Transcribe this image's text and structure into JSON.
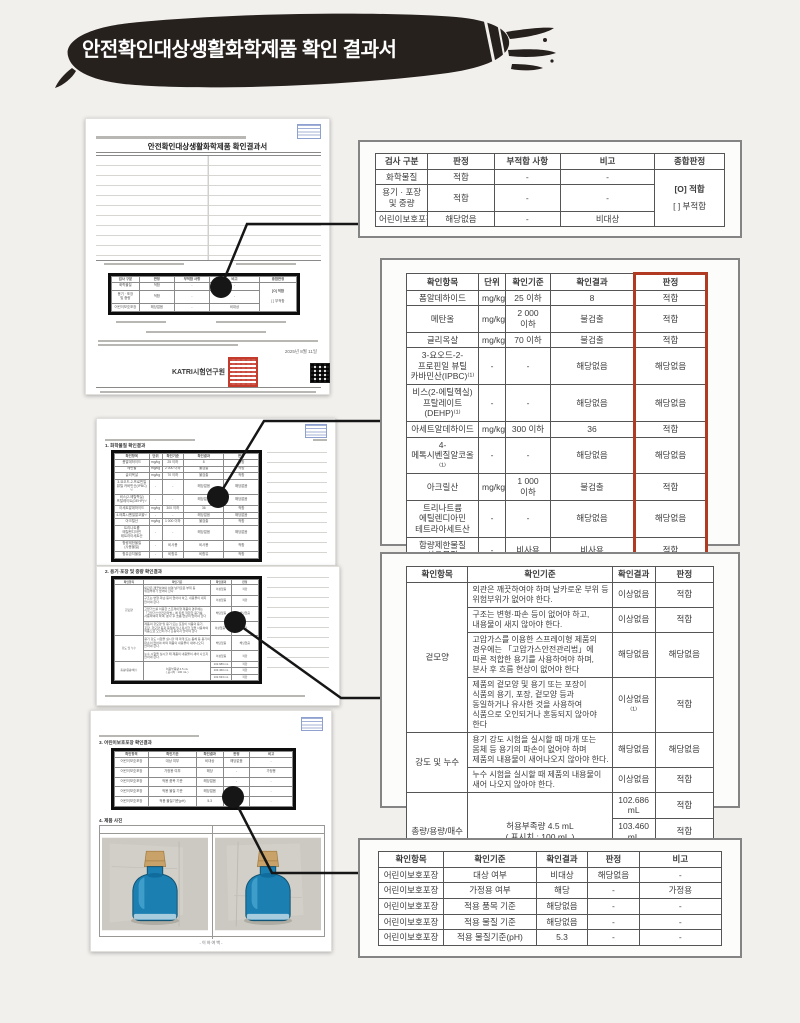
{
  "header": {
    "title": "안전확인대상생활화학제품 확인 결과서"
  },
  "colors": {
    "background": "#f2f0ed",
    "brush_black": "#27211e",
    "header_text": "#ffffff",
    "highlight_box_black": "#0d0d0d",
    "connector_black": "#161616",
    "red_emphasis_column": "#b03a22",
    "seal_red": "#c43b2c",
    "stamp_blue": "#6e86c0",
    "bottle_blue": "#1b7fb2",
    "cork_tan": "#c8a268"
  },
  "documents": {
    "doc1": {
      "title": "안전확인대상생활화학제품 확인결과서",
      "org": "KATRI시험연구원",
      "date": "2025년 8월 11일"
    },
    "doc2": {
      "section": "1. 화학물질 확인결과"
    },
    "doc3": {
      "section": "2. 용기·포장 및 중량 확인결과"
    },
    "doc4": {
      "section_child": "3. 어린이보호포장 확인결과",
      "section_photo": "4. 제품 사진",
      "caption": "- 이 하 여 백 -"
    }
  },
  "tables": {
    "summary": {
      "headers": [
        "검사 구분",
        "판정",
        "부적합 사항",
        "비고",
        "종합판정"
      ],
      "widths": [
        15,
        19,
        19,
        27,
        20
      ],
      "rows": [
        [
          {
            "t": "화학물질"
          },
          {
            "t": "적합"
          },
          {
            "t": "-"
          },
          {
            "t": "-"
          },
          {
            "lines": [
              "[O]  적합",
              "[ ]  부적합"
            ],
            "rs": 3
          }
        ],
        [
          {
            "t": "용기 · 포장\n및 중량"
          },
          {
            "t": "적합"
          },
          {
            "t": "-"
          },
          {
            "t": "-"
          }
        ],
        [
          {
            "t": "어린이보호포장"
          },
          {
            "t": "해당없음"
          },
          {
            "t": "-"
          },
          {
            "t": "비대상"
          }
        ]
      ]
    },
    "chemical": {
      "headers": [
        "확인항목",
        "단위",
        "확인기준",
        "확인결과",
        {
          "t": "판정",
          "cls": "rc rct"
        }
      ],
      "widths": [
        24,
        9,
        15,
        28,
        24
      ],
      "rows": [
        [
          {
            "t": "폼알데하이드"
          },
          {
            "t": "mg/kg"
          },
          {
            "t": "25 이하"
          },
          {
            "t": "8"
          },
          {
            "t": "적합",
            "cls": "rc"
          }
        ],
        [
          {
            "t": "메탄올"
          },
          {
            "t": "mg/kg"
          },
          {
            "t": "2 000 이하"
          },
          {
            "t": "불검출"
          },
          {
            "t": "적합",
            "cls": "rc"
          }
        ],
        [
          {
            "t": "글리옥살"
          },
          {
            "t": "mg/kg"
          },
          {
            "t": "70 이하"
          },
          {
            "t": "불검출"
          },
          {
            "t": "적합",
            "cls": "rc"
          }
        ],
        [
          {
            "t": "3-요오드-2-프로핀일 뷰틸 카바민산(IPBC)⁽¹⁾"
          },
          {
            "t": "-"
          },
          {
            "t": "-"
          },
          {
            "t": "해당없음"
          },
          {
            "t": "해당없음",
            "cls": "rc"
          }
        ],
        [
          {
            "t": "비스(2-에틸헥실)프탈레이트(DEHP)⁽¹⁾"
          },
          {
            "t": "-"
          },
          {
            "t": "-"
          },
          {
            "t": "해당없음"
          },
          {
            "t": "해당없음",
            "cls": "rc"
          }
        ],
        [
          {
            "t": "아세트알데하이드"
          },
          {
            "t": "mg/kg"
          },
          {
            "t": "300 이하"
          },
          {
            "t": "36"
          },
          {
            "t": "적합",
            "cls": "rc"
          }
        ],
        [
          {
            "t": "4-메톡시벤질알코올⁽¹⁾"
          },
          {
            "t": "-"
          },
          {
            "t": "-"
          },
          {
            "t": "해당없음"
          },
          {
            "t": "해당없음",
            "cls": "rc"
          }
        ],
        [
          {
            "t": "아크릴산"
          },
          {
            "t": "mg/kg"
          },
          {
            "t": "1 000 이하"
          },
          {
            "t": "불검출"
          },
          {
            "t": "적합",
            "cls": "rc"
          }
        ],
        [
          {
            "t": "트리나트륨 에틸렌디아민 테트라아세트산"
          },
          {
            "t": "-"
          },
          {
            "t": "-"
          },
          {
            "t": "해당없음"
          },
          {
            "t": "해당없음",
            "cls": "rc"
          }
        ],
        [
          {
            "t": "함량제한물질\n(사용물질)"
          },
          {
            "t": "-"
          },
          {
            "t": "비사용"
          },
          {
            "t": "비사용"
          },
          {
            "t": "적합",
            "cls": "rc"
          }
        ],
        [
          {
            "t": "함유금지물질"
          },
          {
            "t": "-"
          },
          {
            "t": "비함유"
          },
          {
            "t": "비함유"
          },
          {
            "t": "적합",
            "cls": "rc rcb"
          }
        ]
      ]
    },
    "package": {
      "headers": [
        "확인항목",
        "확인기준",
        "확인결과",
        "판정"
      ],
      "widths": [
        20,
        47,
        14,
        19
      ],
      "rows": [
        [
          {
            "t": "겉모양",
            "rs": 4
          },
          {
            "t": "외관은 깨끗하여야 하며 날카로운 부위 등 위험부위가 없어야 한다.",
            "cls": "left"
          },
          {
            "t": "이상없음"
          },
          {
            "t": "적합"
          }
        ],
        [
          {
            "t": "구조는 변형·파손 등이 없어야 하고, 내용물이 새지 않아야 한다.",
            "cls": "left"
          },
          {
            "t": "이상없음"
          },
          {
            "t": "적합"
          }
        ],
        [
          {
            "t": "고압가스를 이용한 스프레이형 제품의 경우에는 「고압가스안전관리법」에 따른 적합한 용기를 사용하여야 하며, 분사 후 흐름 현상이 없어야 한다",
            "cls": "left"
          },
          {
            "t": "해당없음"
          },
          {
            "t": "해당없음"
          }
        ],
        [
          {
            "t": "제품의 겉모양 및 용기 또는 포장이 식품의 용기, 포장, 겉모양 등과 동일하거나 유사한 것을 사용하여 식품으로 오인되거나 혼동되지 않아야 한다",
            "cls": "left"
          },
          {
            "t": "이상없음⁽¹⁾"
          },
          {
            "t": "적합"
          }
        ],
        [
          {
            "t": "강도 및 누수",
            "rs": 2
          },
          {
            "t": "용기 강도 시험을 실시할 때 마개 또는 몸체 등 용기의 파손이 없어야 하며 제품의 내용물이 새어나오지 않아야 한다.",
            "cls": "left"
          },
          {
            "t": "해당없음"
          },
          {
            "t": "해당없음"
          }
        ],
        [
          {
            "t": "누수 시험을 실시할 때 제품의 내용물이 새어 나오지 않아야 한다.",
            "cls": "left"
          },
          {
            "t": "이상없음"
          },
          {
            "t": "적합"
          }
        ],
        [
          {
            "t": "총량/용량/매수",
            "rs": 3
          },
          {
            "t": "허용부족량  4.5 mL\n( 표시치 : 100 mL )",
            "rs": 3
          },
          {
            "t": "102.686 mL"
          },
          {
            "t": "적합"
          }
        ],
        [
          {
            "t": "103.460 mL"
          },
          {
            "t": "적합"
          }
        ],
        [
          {
            "t": "102.633 mL"
          },
          {
            "t": "적합"
          }
        ]
      ]
    },
    "child": {
      "headers": [
        "확인항목",
        "확인기준",
        "확인결과",
        "판정",
        "비고"
      ],
      "widths": [
        19,
        27,
        15,
        15,
        24
      ],
      "rows": [
        [
          {
            "t": "어린이보호포장"
          },
          {
            "t": "대상 여부"
          },
          {
            "t": "비대상"
          },
          {
            "t": "해당없음"
          },
          {
            "t": "-"
          }
        ],
        [
          {
            "t": "어린이보호포장"
          },
          {
            "t": "가정용 여부"
          },
          {
            "t": "해당"
          },
          {
            "t": "-"
          },
          {
            "t": "가정용"
          }
        ],
        [
          {
            "t": "어린이보호포장"
          },
          {
            "t": "적용 품목 기준"
          },
          {
            "t": "해당없음"
          },
          {
            "t": "-"
          },
          {
            "t": "-"
          }
        ],
        [
          {
            "t": "어린이보호포장"
          },
          {
            "t": "적용 물질 기준"
          },
          {
            "t": "해당없음"
          },
          {
            "t": "-"
          },
          {
            "t": "-"
          }
        ],
        [
          {
            "t": "어린이보호포장"
          },
          {
            "t": "적용 물질기준(pH)"
          },
          {
            "t": "5.3"
          },
          {
            "t": "-"
          },
          {
            "t": "-"
          }
        ]
      ]
    }
  }
}
